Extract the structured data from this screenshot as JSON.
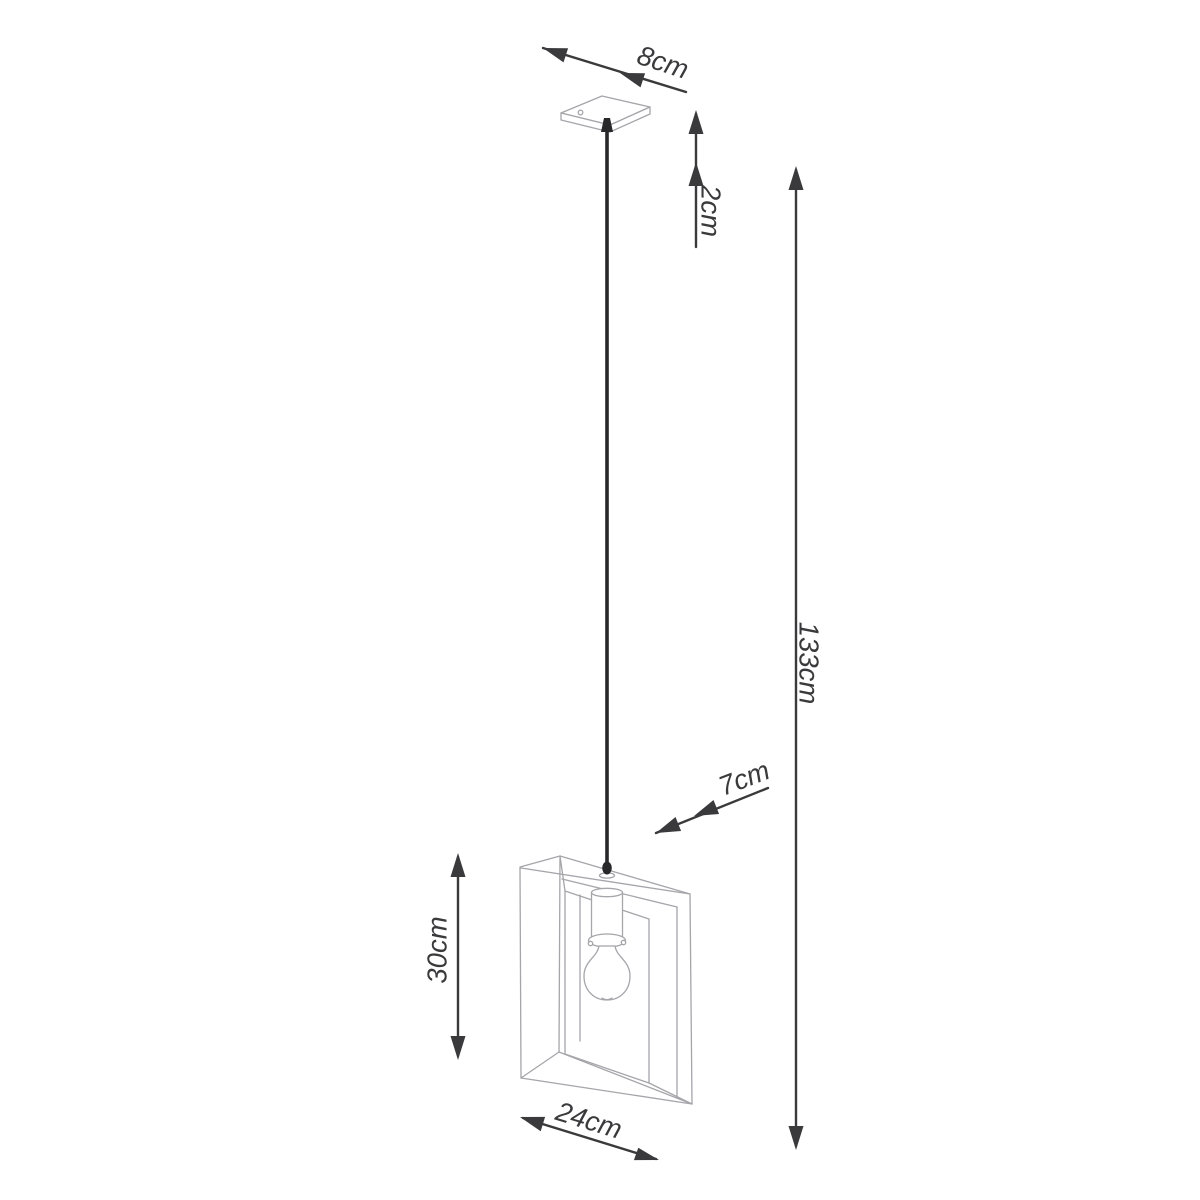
{
  "dimensions": {
    "canopy_width": "8cm",
    "canopy_height": "2cm",
    "overall_height": "133cm",
    "frame_depth": "7cm",
    "frame_height": "30cm",
    "frame_width": "24cm"
  },
  "colors": {
    "background": "#ffffff",
    "outline": "#a5a5aa",
    "dimension": "#3a3a3c",
    "cable": "#28282a"
  }
}
